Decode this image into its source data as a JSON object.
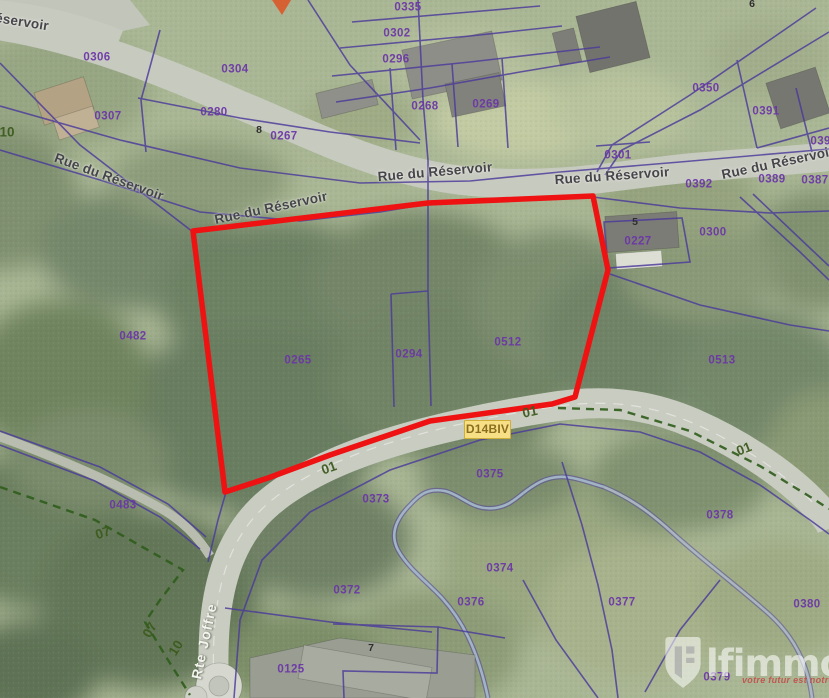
{
  "map_type": "cadastral-aerial",
  "colors": {
    "highlight_red": "#ee1213",
    "parcel_line_purple": "#4b3a9b",
    "parcel_text_purple": "#6b35a8",
    "road_number_green": "#3d5b1f",
    "street_text_gray": "#45454b",
    "boundary_dash_green": "#2f5c1c",
    "badge_bg_yellow": "#f6df84",
    "badge_text": "#8a6d1f",
    "stream_blue": "#a6bccb"
  },
  "route_badge": {
    "label": "D14BIV"
  },
  "watermark": {
    "brand": "lfimmo",
    "tagline": "votre futur est notre pas"
  },
  "labels": {
    "streets": [
      {
        "text": "éservoir",
        "x": 22,
        "y": 22,
        "rot": 9
      },
      {
        "text": "Rue du Réservoir",
        "x": 109,
        "y": 177,
        "rot": 20
      },
      {
        "text": "Rue du Réservoir",
        "x": 271,
        "y": 208,
        "rot": -12
      },
      {
        "text": "Rue du Réservoir",
        "x": 435,
        "y": 172,
        "rot": -5
      },
      {
        "text": "Rue du Réservoir",
        "x": 612,
        "y": 176,
        "rot": -4
      },
      {
        "text": "Rue du Réservoir",
        "x": 778,
        "y": 163,
        "rot": -12
      },
      {
        "text": "Rte Joffre",
        "x": 204,
        "y": 641,
        "rot": -78,
        "white": true
      }
    ],
    "parcels": [
      {
        "text": "0306",
        "x": 97,
        "y": 58
      },
      {
        "text": "0304",
        "x": 235,
        "y": 70
      },
      {
        "text": "0307",
        "x": 108,
        "y": 117
      },
      {
        "text": "0280",
        "x": 214,
        "y": 113
      },
      {
        "text": "0267",
        "x": 284,
        "y": 137
      },
      {
        "text": "0335",
        "x": 408,
        "y": 8
      },
      {
        "text": "0302",
        "x": 397,
        "y": 34
      },
      {
        "text": "0296",
        "x": 396,
        "y": 60
      },
      {
        "text": "0268",
        "x": 425,
        "y": 107
      },
      {
        "text": "0269",
        "x": 486,
        "y": 105
      },
      {
        "text": "0350",
        "x": 706,
        "y": 89
      },
      {
        "text": "0391",
        "x": 766,
        "y": 112
      },
      {
        "text": "0390",
        "x": 824,
        "y": 142
      },
      {
        "text": "0301",
        "x": 618,
        "y": 156
      },
      {
        "text": "0392",
        "x": 699,
        "y": 185
      },
      {
        "text": "0389",
        "x": 772,
        "y": 180
      },
      {
        "text": "0387",
        "x": 815,
        "y": 181
      },
      {
        "text": "0227",
        "x": 638,
        "y": 242
      },
      {
        "text": "0300",
        "x": 713,
        "y": 233
      },
      {
        "text": "0482",
        "x": 133,
        "y": 337
      },
      {
        "text": "0265",
        "x": 298,
        "y": 361
      },
      {
        "text": "0294",
        "x": 409,
        "y": 355
      },
      {
        "text": "0512",
        "x": 508,
        "y": 343
      },
      {
        "text": "0513",
        "x": 722,
        "y": 361
      },
      {
        "text": "0483",
        "x": 123,
        "y": 506
      },
      {
        "text": "0373",
        "x": 376,
        "y": 500
      },
      {
        "text": "0375",
        "x": 490,
        "y": 475
      },
      {
        "text": "0374",
        "x": 500,
        "y": 569
      },
      {
        "text": "0372",
        "x": 347,
        "y": 591
      },
      {
        "text": "0376",
        "x": 471,
        "y": 603
      },
      {
        "text": "0377",
        "x": 622,
        "y": 603
      },
      {
        "text": "0378",
        "x": 720,
        "y": 516
      },
      {
        "text": "0379",
        "x": 717,
        "y": 678
      },
      {
        "text": "0380",
        "x": 807,
        "y": 605
      },
      {
        "text": "0125",
        "x": 291,
        "y": 670
      }
    ],
    "road_numbers": [
      {
        "text": "01",
        "x": 530,
        "y": 412,
        "rot": -12
      },
      {
        "text": "01",
        "x": 329,
        "y": 468,
        "rot": -20
      },
      {
        "text": "01",
        "x": 744,
        "y": 449,
        "rot": -22
      },
      {
        "text": "07",
        "x": 103,
        "y": 533,
        "rot": -18
      },
      {
        "text": "07",
        "x": 150,
        "y": 630,
        "rot": -60
      },
      {
        "text": "10",
        "x": 176,
        "y": 648,
        "rot": -58
      },
      {
        "text": "10",
        "x": 7,
        "y": 132,
        "rot": 0
      }
    ],
    "house_numbers": [
      {
        "text": "8",
        "x": 259,
        "y": 130
      },
      {
        "text": "5",
        "x": 635,
        "y": 222
      },
      {
        "text": "6",
        "x": 752,
        "y": 4
      },
      {
        "text": "7",
        "x": 371,
        "y": 648
      }
    ]
  }
}
